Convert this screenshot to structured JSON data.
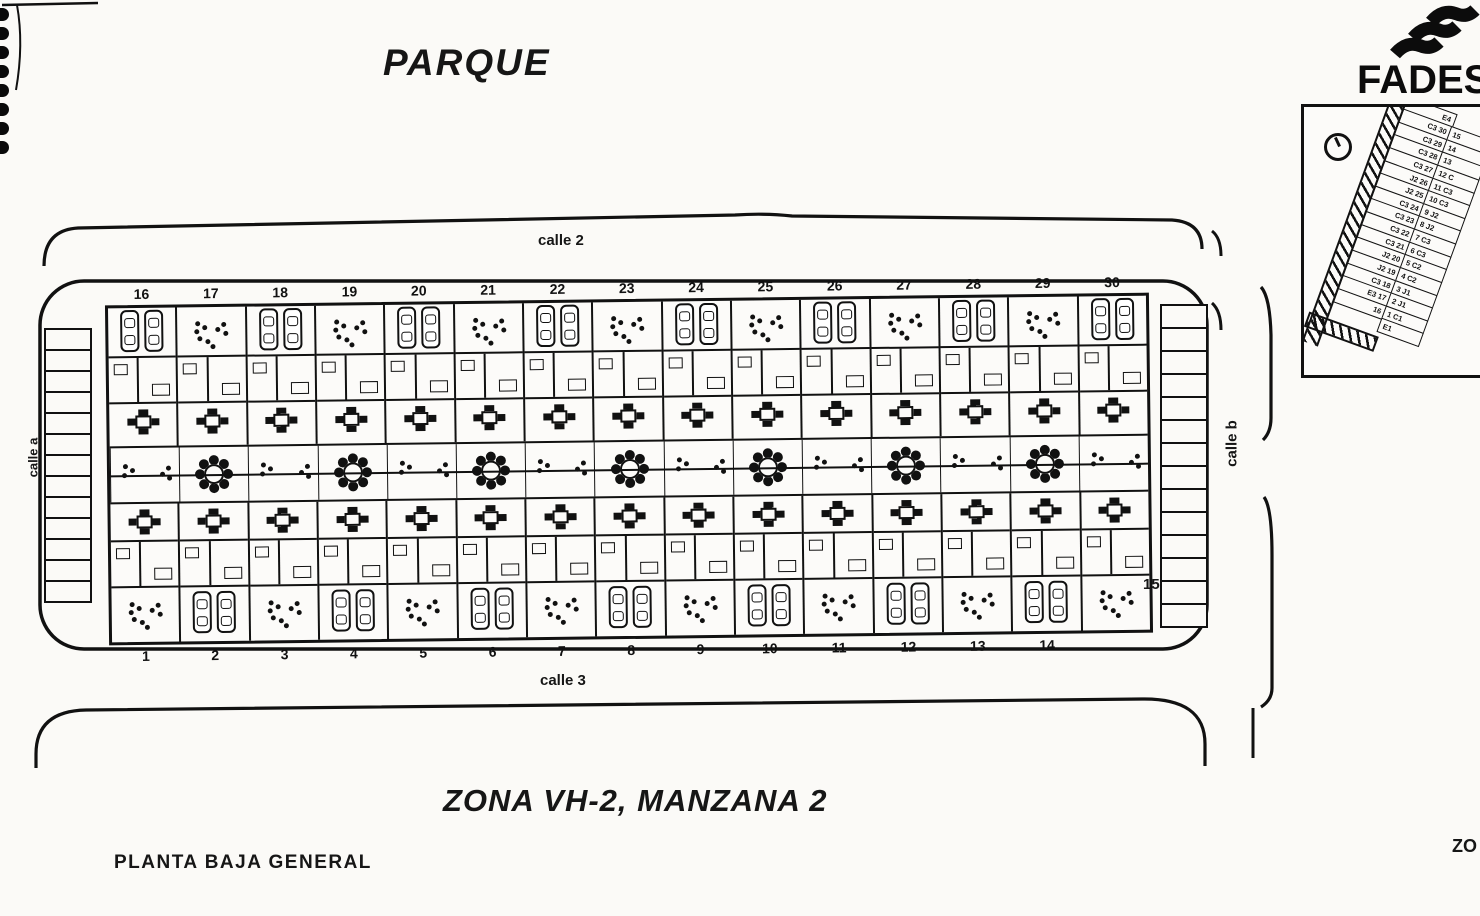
{
  "page": {
    "background": "#fbfaf7",
    "ink": "#111111"
  },
  "labels": {
    "park": "PARQUE",
    "zone_title": "ZONA  VH-2, MANZANA 2",
    "plan_subtitle": "PLANTA BAJA GENERAL",
    "right_edge_partial": "ZO"
  },
  "brand": {
    "name_visible": "FADES"
  },
  "streets": {
    "top": "calle 2",
    "bottom": "calle 3",
    "left": "calle a",
    "right": "calle b"
  },
  "block": {
    "top_unit_numbers": [
      "16",
      "17",
      "18",
      "19",
      "20",
      "21",
      "22",
      "23",
      "24",
      "25",
      "26",
      "27",
      "28",
      "29",
      "30"
    ],
    "bottom_unit_numbers": [
      "1",
      "2",
      "3",
      "4",
      "5",
      "6",
      "7",
      "8",
      "9",
      "10",
      "11",
      "12",
      "13",
      "14"
    ],
    "right_end_unit_number": "15",
    "units_per_row": 15,
    "garden_cells": 15,
    "parking_left_stalls": 13,
    "parking_right_stalls": 14
  },
  "keyplan": {
    "rows": [
      {
        "left": "E4",
        "right": ""
      },
      {
        "left": "C3 30",
        "right": "15"
      },
      {
        "left": "C3 29",
        "right": "14"
      },
      {
        "left": "C3 28",
        "right": "13"
      },
      {
        "left": "C3 27",
        "right": "12 C"
      },
      {
        "left": "J2 26",
        "right": "11 C3"
      },
      {
        "left": "J2 25",
        "right": "10 C3"
      },
      {
        "left": "C3 24",
        "right": "9 J2"
      },
      {
        "left": "C3 23",
        "right": "8 J2"
      },
      {
        "left": "C3 22",
        "right": "7 C3"
      },
      {
        "left": "C3 21",
        "right": "6 C3"
      },
      {
        "left": "J2 20",
        "right": "5 C2"
      },
      {
        "left": "J2 19",
        "right": "4 C2"
      },
      {
        "left": "C3 18",
        "right": "3 J1"
      },
      {
        "left": "E3 17",
        "right": "2 J1"
      },
      {
        "left": "16",
        "right": "1 C1"
      },
      {
        "left": "",
        "right": "E1"
      }
    ]
  }
}
